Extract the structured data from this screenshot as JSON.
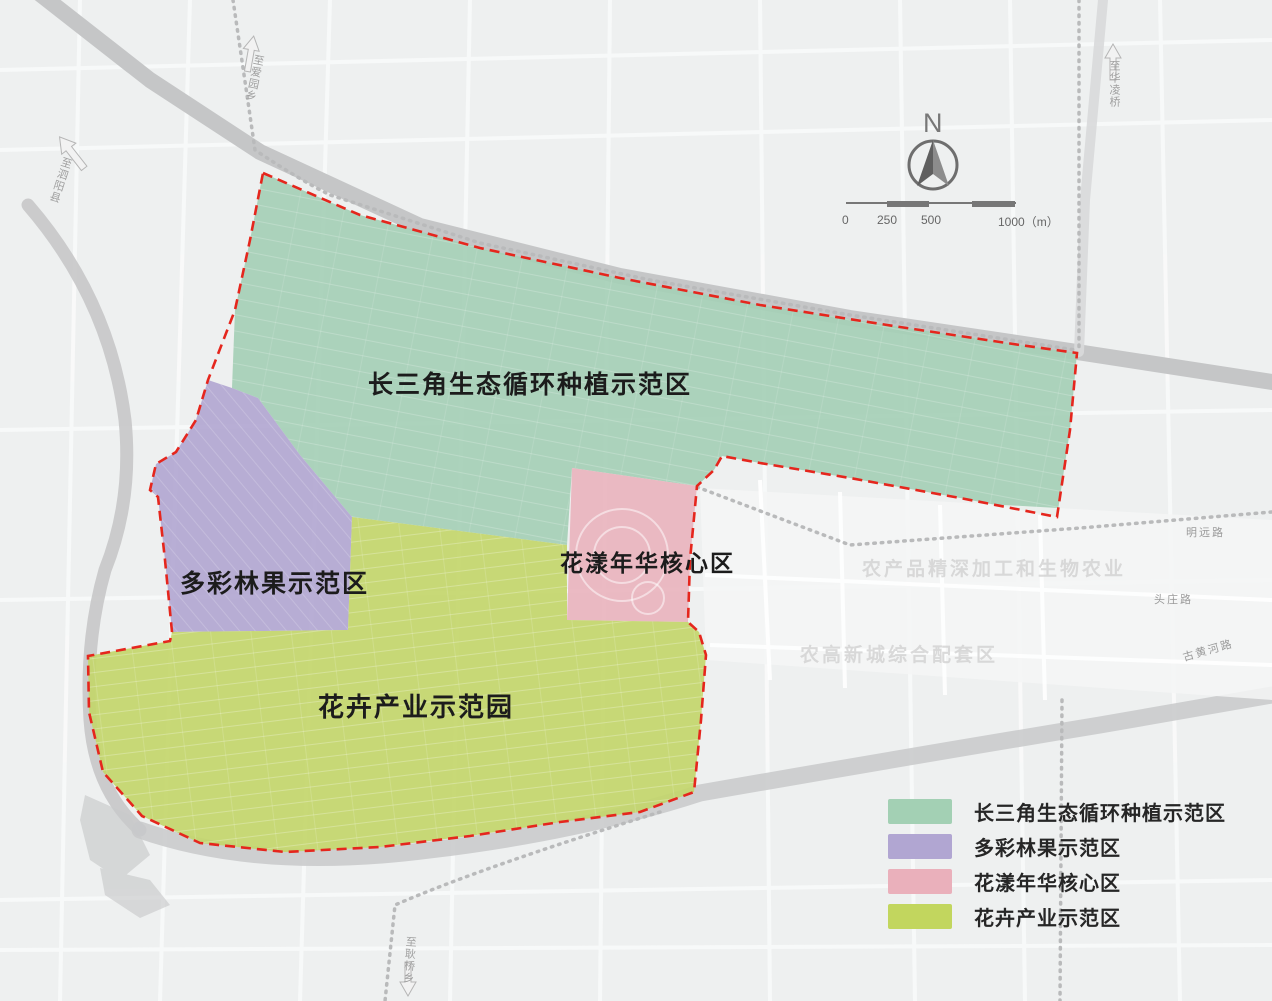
{
  "title": "农业园区功能分区规划图",
  "colors": {
    "boundary_red": "#e5261d",
    "band_gray": "#c4c5c6",
    "rail_gray": "#b9babb"
  },
  "zones": [
    {
      "id": "green",
      "label": "长三角生态循环种植示范区",
      "color": "#a5cfb6"
    },
    {
      "id": "purple",
      "label": "多彩林果示范区",
      "color": "#b2a7d1"
    },
    {
      "id": "pink",
      "label": "花漾年华核心区",
      "color": "#e9b4be"
    },
    {
      "id": "yellow",
      "label": "花卉产业示范园",
      "color": "#c3d66b"
    }
  ],
  "legend": {
    "items": [
      {
        "label": "长三角生态循环种植示范区",
        "color": "#a3d0b4"
      },
      {
        "label": "多彩林果示范区",
        "color": "#b1a6d2"
      },
      {
        "label": "花漾年华核心区",
        "color": "#eab0bb"
      },
      {
        "label": "花卉产业示范区",
        "color": "#c2d65e"
      }
    ]
  },
  "north": {
    "label": "N"
  },
  "scalebar": {
    "tick0": "0",
    "tick250": "250",
    "tick500": "500",
    "tick1000": "1000（m）"
  },
  "roads": {
    "mingyuan": "明远路",
    "touzhuang": "头庄路",
    "guhuanghe": "古黄河路"
  },
  "edges": {
    "left": "至泗阳县",
    "top_left": "至爱园乡",
    "top_right": "至华凌桥",
    "bottom": "至耿桥乡"
  },
  "watermarks": {
    "agro": "农产品精深加工和生物农业",
    "city": "农高新城综合配套区"
  }
}
